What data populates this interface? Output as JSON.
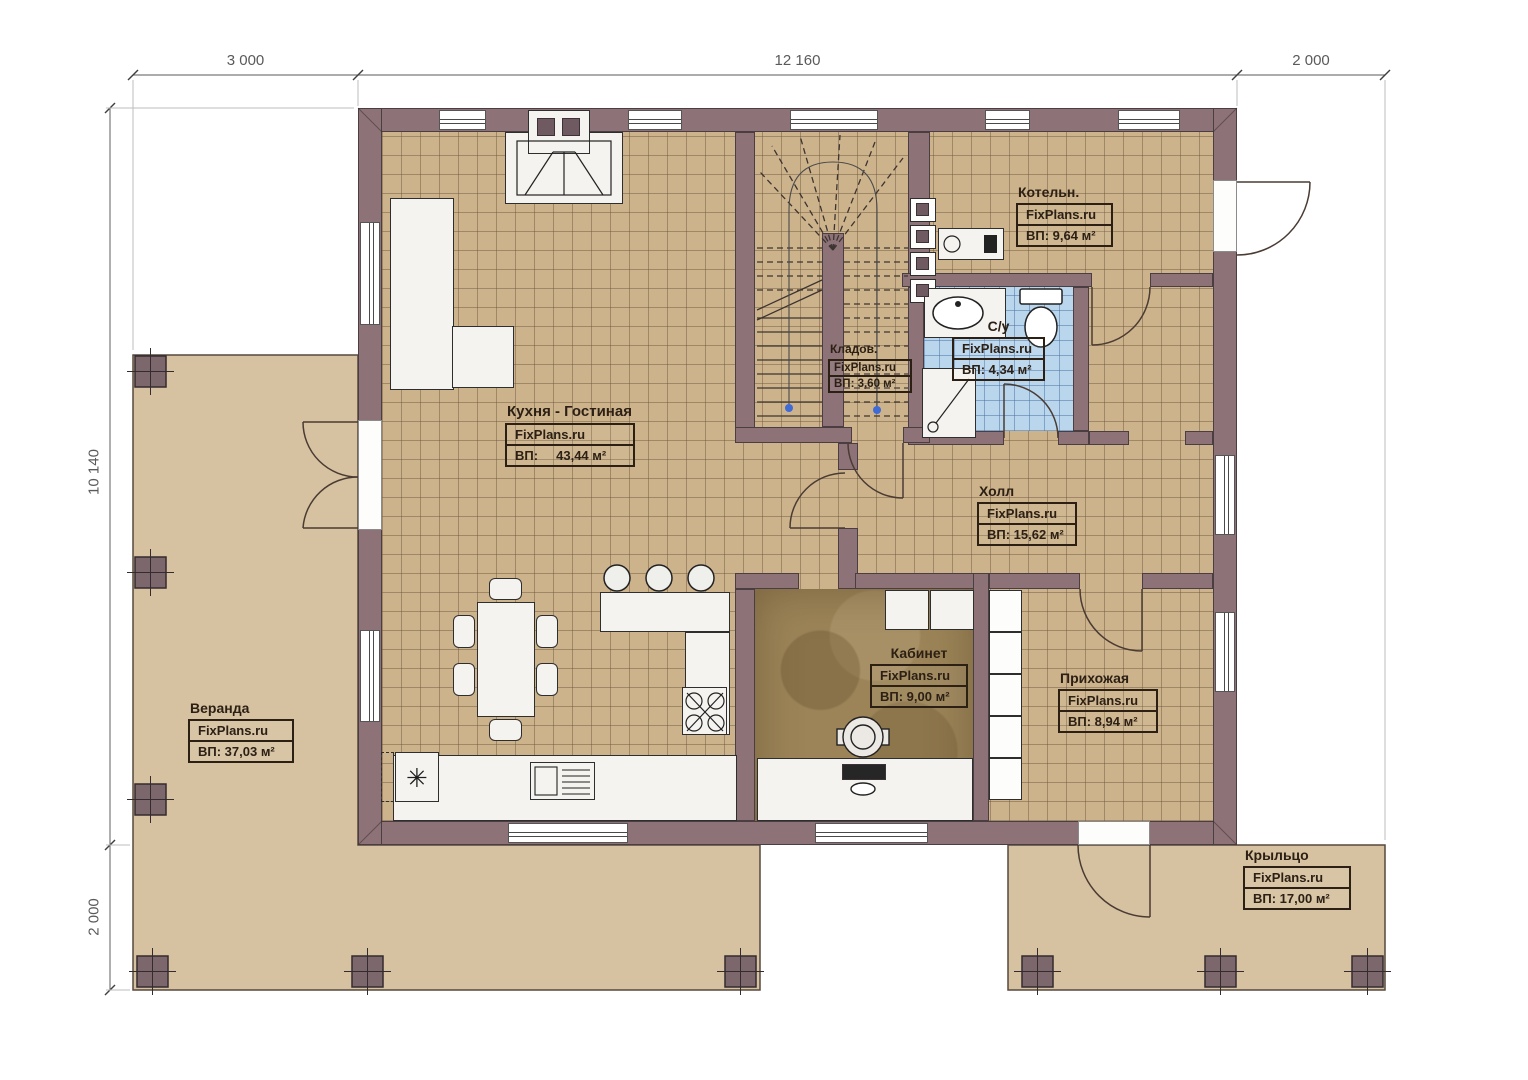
{
  "watermark": "FixPlans.ru",
  "dims": {
    "top_left": "3 000",
    "top_mid": "12 160",
    "top_right": "2 000",
    "left_top": "10 140",
    "left_bottom": "2 000"
  },
  "rooms": {
    "kitchen": {
      "name": "Кухня - Гостиная",
      "brand": "FixPlans.ru",
      "area": "ВП:     43,44 м²"
    },
    "boiler": {
      "name": "Котельн.",
      "brand": "FixPlans.ru",
      "area": "ВП: 9,64 м²"
    },
    "bath": {
      "name": "С/у",
      "brand": "FixPlans.ru",
      "area": "ВП: 4,34 м²"
    },
    "storage": {
      "name": "Кладов.",
      "brand": "FixPlans.ru",
      "area": "ВП: 3,60 м²"
    },
    "hall": {
      "name": "Холл",
      "brand": "FixPlans.ru",
      "area": "ВП: 15,62 м²"
    },
    "office": {
      "name": "Кабинет",
      "brand": "FixPlans.ru",
      "area": "ВП: 9,00 м²"
    },
    "entry": {
      "name": "Прихожая",
      "brand": "FixPlans.ru",
      "area": "ВП: 8,94 м²"
    },
    "veranda": {
      "name": "Веранда",
      "brand": "FixPlans.ru",
      "area": "ВП: 37,03 м²"
    },
    "porch": {
      "name": "Крыльцо",
      "brand": "FixPlans.ru",
      "area": "ВП: 17,00 м²"
    }
  },
  "colors": {
    "wall": "#8d7377",
    "tile_floor": "#cdb38c",
    "bath_floor": "#bad6ec",
    "office_floor": "#9c8458",
    "deck": "#d6c2a1",
    "label_ink": "#2c2015",
    "stair_marker": "#3f6bd6"
  }
}
